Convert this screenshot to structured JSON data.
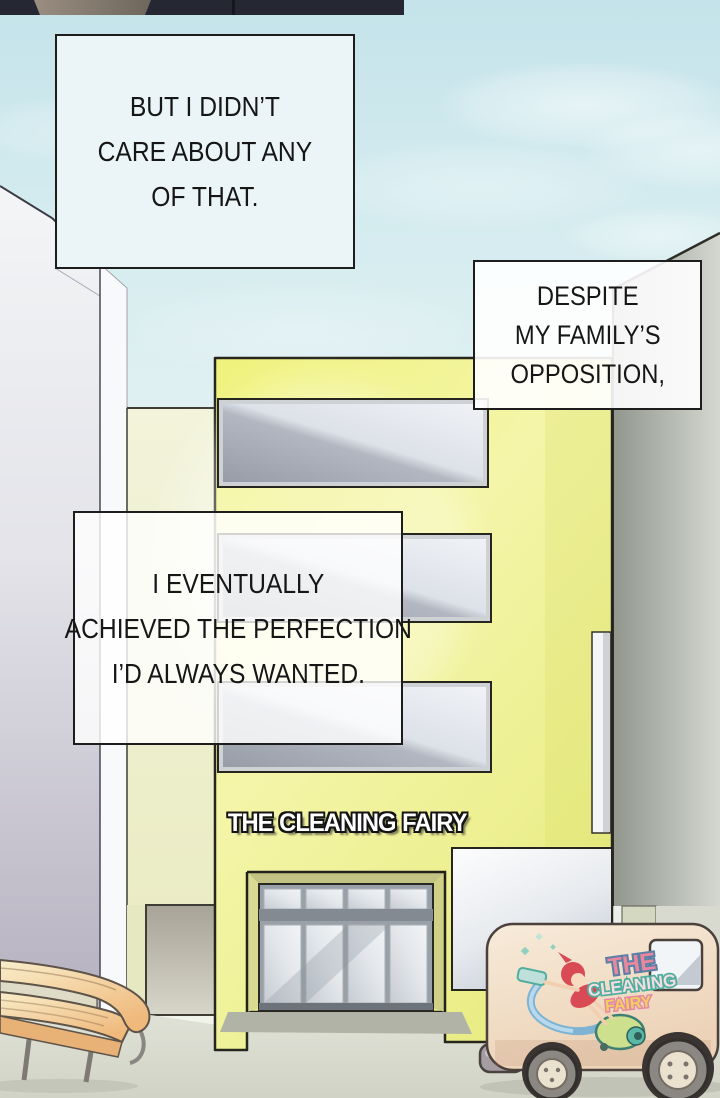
{
  "captions": {
    "box1": {
      "line1": "BUT I DIDN’T",
      "line2": "CARE ABOUT ANY",
      "line3": "OF THAT."
    },
    "box2": {
      "line1": "DESPITE",
      "line2": "MY FAMILY’S",
      "line3": "OPPOSITION,"
    },
    "box3": {
      "line1": "I EVENTUALLY",
      "line2": "ACHIEVED THE PERFECTION",
      "line3": "I’D ALWAYS WANTED."
    }
  },
  "building": {
    "sign_text": "THE CLEANING FAIRY"
  },
  "van": {
    "logo": {
      "the": "THE",
      "cleaning": "CLEANING",
      "fairy": "FAIRY"
    }
  },
  "colors": {
    "building_yellow": "#eff076",
    "wing_yellow": "#f1f2d8",
    "sky_blue": "#cfe9ee",
    "van_cream": "#f2dfc9",
    "logo_teal": "#4fae9e",
    "logo_pink": "#e8879e",
    "fairy_red": "#d84b55",
    "gray_building": "#a8ada4",
    "ground": "#d8dbcd"
  }
}
